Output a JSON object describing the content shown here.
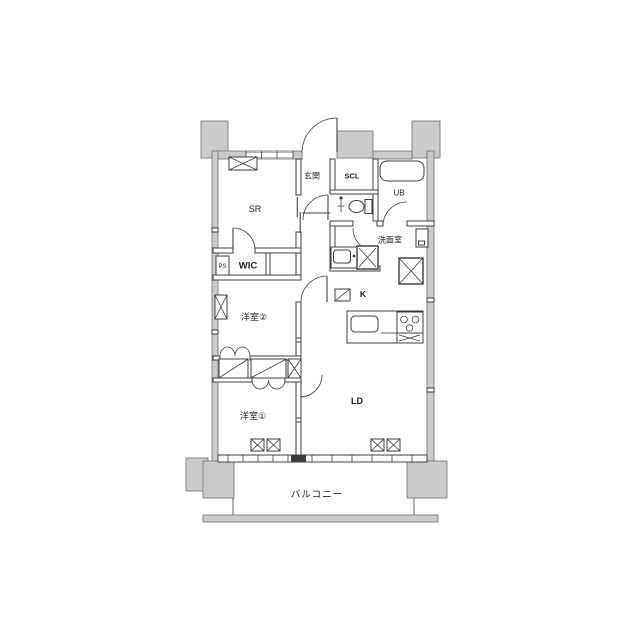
{
  "floorplan": {
    "labels": {
      "sr": "SR",
      "genkan": "玄関",
      "scl": "SCL",
      "ub": "UB",
      "senmen": "洗面室",
      "wic": "WIC",
      "ps": "PS",
      "yo2": "洋室②",
      "k": "K",
      "ld": "LD",
      "yo1": "洋室①",
      "balcony": "バルコニー"
    },
    "colors": {
      "exterior_wall": "#cbcbcb",
      "line": "#3c3c3c",
      "background": "#ffffff"
    }
  }
}
